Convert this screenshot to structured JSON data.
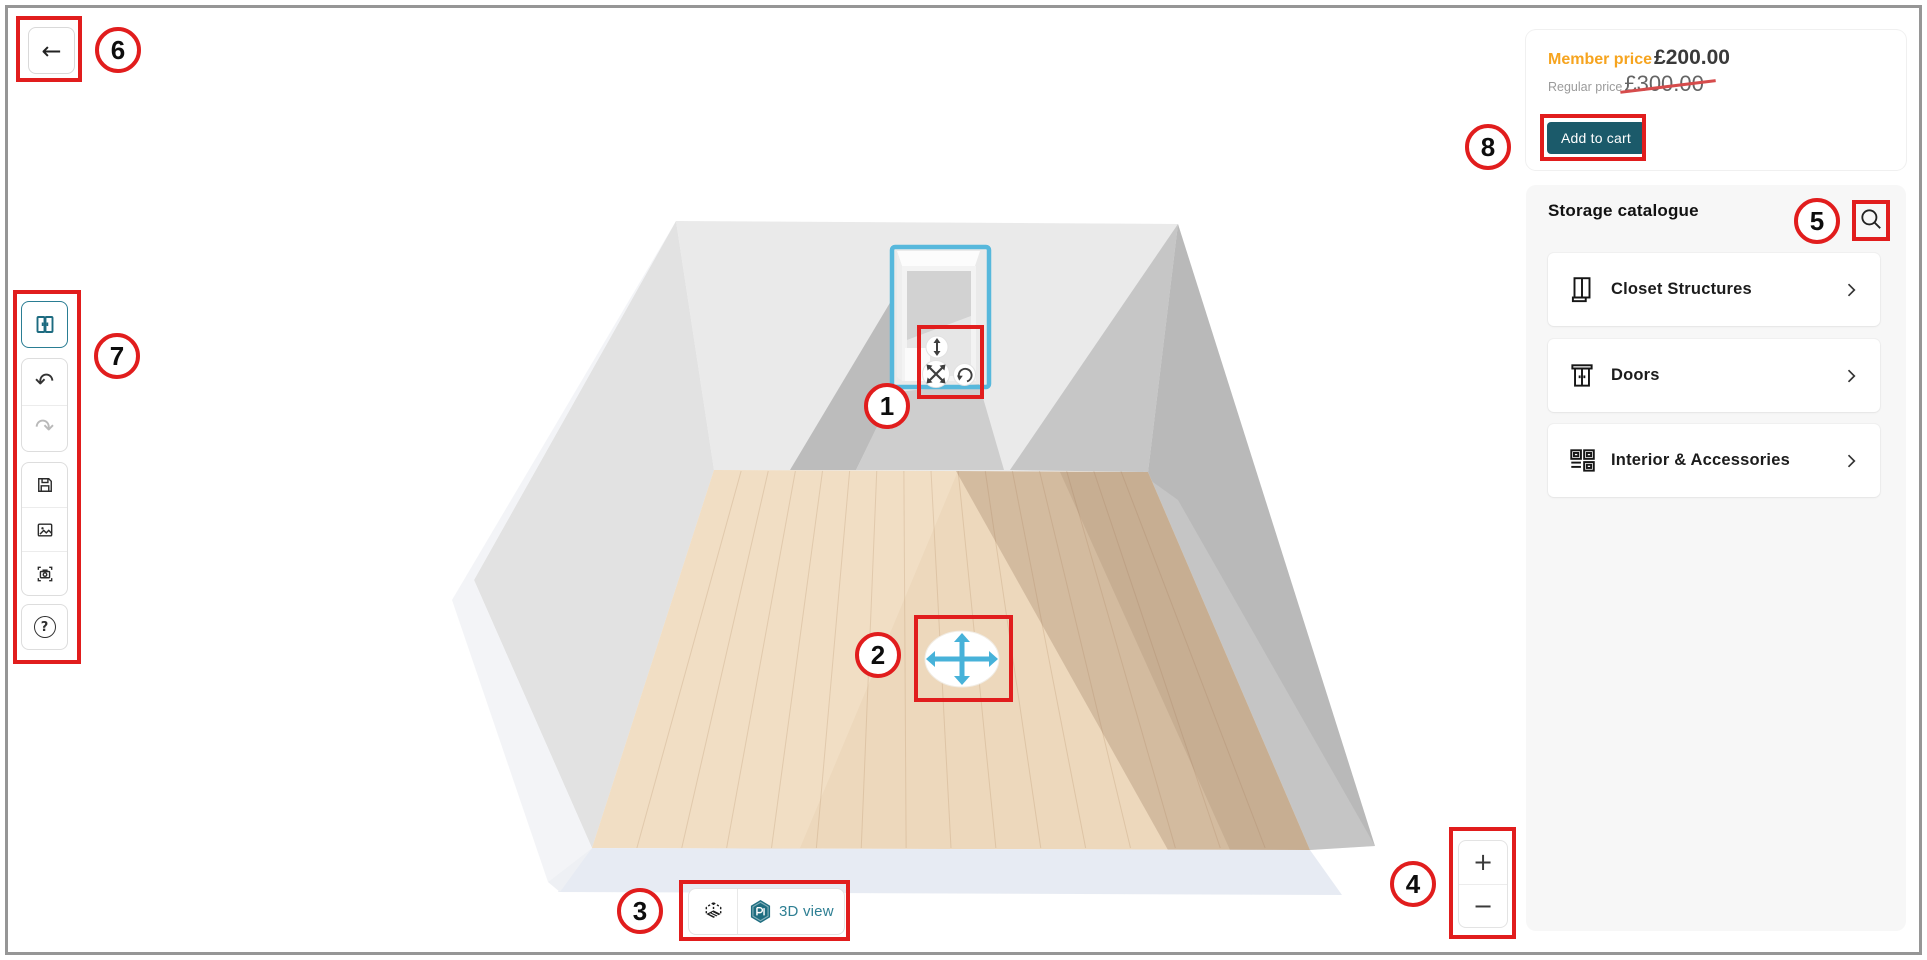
{
  "header": {
    "back_icon": "←"
  },
  "icons": {
    "undo": "↶",
    "redo": "↷",
    "help": "?",
    "plus": "+",
    "minus": "−"
  },
  "price_panel": {
    "member_label": "Member price",
    "member_price": "£200.00",
    "regular_label": "Regular price",
    "regular_price": "£300.00",
    "add_to_cart_label": "Add to cart"
  },
  "catalogue": {
    "title": "Storage catalogue",
    "items": [
      {
        "label": "Closet Structures"
      },
      {
        "label": "Doors"
      },
      {
        "label": "Interior & Accessories"
      }
    ]
  },
  "view_toggle": {
    "label_3d": "3D view"
  },
  "annotations": {
    "markers": [
      {
        "n": "1"
      },
      {
        "n": "2"
      },
      {
        "n": "3"
      },
      {
        "n": "4"
      },
      {
        "n": "5"
      },
      {
        "n": "6"
      },
      {
        "n": "7"
      },
      {
        "n": "8"
      }
    ]
  },
  "colors": {
    "annotation_red": "#e11d1d",
    "accent_teal": "#2e7f93",
    "add_to_cart_teal": "#1b5a6a",
    "member_price_orange": "#f6a41f",
    "selection_blue": "#57b8dc",
    "move_arrow_blue": "#47b2d9",
    "floor_wood": "#edd8bc",
    "wall_gray": "#eaeaea"
  }
}
